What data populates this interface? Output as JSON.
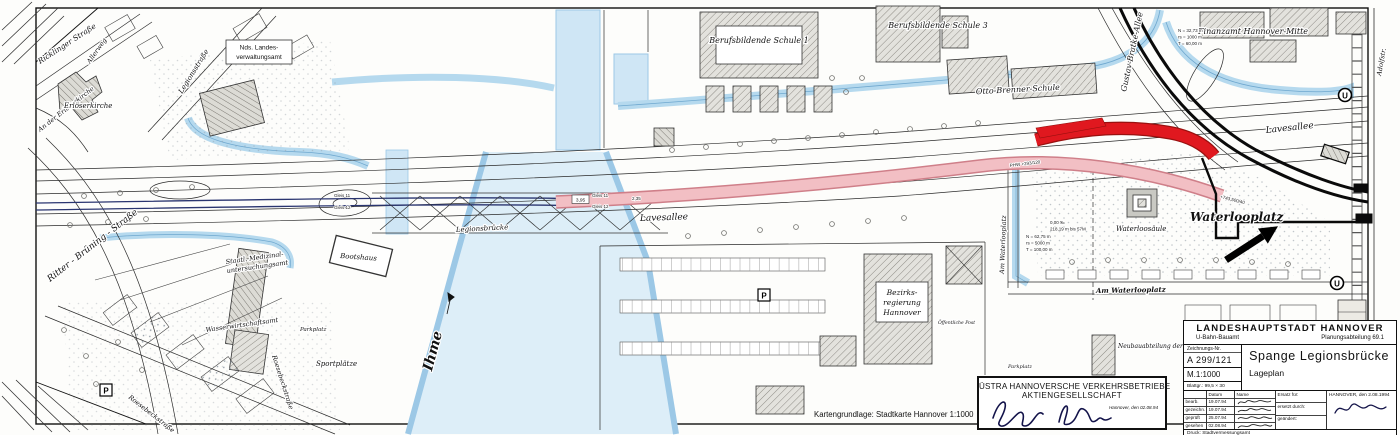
{
  "map": {
    "labels": {
      "ricklinger_strasse": "Ricklinger Straße",
      "allerweg": "Allerweg",
      "an_der_erloeserkirche": "An der Erlöserkirche",
      "erloeserkirche": "Erlöserkirche",
      "legionsstrasse": "Legionsstraße",
      "nds_landesamt_line1": "Nds. Landes-",
      "nds_landesamt_line2": "verwaltungsamt",
      "ritter_bruening_strasse": "Ritter - Brüning - Straße",
      "staatl_medizinal_line1": "Staatl. Medizinal-",
      "staatl_medizinal_line2": "untersuchungsamt",
      "wasserwirtschaftsamt": "Wasserwirtschaftsamt",
      "roesebeckstrasse": "Roesebeckstraße",
      "sportplaetze": "Sportplätze",
      "parkplatz": "Parkplatz",
      "bootshaus": "Bootshaus",
      "legionsbruecke": "Legionsbrücke",
      "ihme": "Ihme",
      "lavesallee": "Lavesallee",
      "berufsbildende_schule_1": "Berufsbildende Schule 1",
      "berufsbildende_schule_3": "Berufsbildende Schule 3",
      "otto_brenner_schule": "Otto-Brenner-Schule",
      "finanzamt": "Finanzamt Hannover-Mitte",
      "gustav_bratke_allee": "Gustav-Bratke-Allee",
      "adolfstrasse": "Adolfstr.",
      "waterlooplatz": "Waterlooplatz",
      "waterloosaeule": "Waterloosäule",
      "am_waterlooplatz": "Am Waterlooplatz",
      "bezirksregierung_line1": "Bezirks-",
      "bezirksregierung_line2": "regierung",
      "bezirksregierung_line3": "Hannover",
      "oeffentliche_post": "Öffentliche Post",
      "neubauabteilung_wsd": "Neubauabteilung der WSD"
    },
    "annotations": {
      "gleis_11": "Gleis 11",
      "gleis_12": "Gleis 12",
      "mass_3_95": "3,95",
      "mass_2_35": "2,35",
      "phw": "PHW +293/120",
      "station": "+743,500/40",
      "n_62": "N = 62,75 m",
      "rs_5000": "rs = 5000 m",
      "t_100": "T = 100,00 m",
      "grad_0": "0,00 ‰",
      "len_218": "218,19 m bis 57M",
      "n_32": "N = 32,73 m",
      "rs_1000": "rs = 1000 m",
      "t_60": "T = 60,00 m"
    },
    "symbols": {
      "u_station": "U",
      "parking": "P"
    }
  },
  "title_block": {
    "authority": "LANDESHAUPTSTADT  HANNOVER",
    "office": "U-Bahn-Bauamt",
    "department": "Planungsabteilung 69.1",
    "drawing_no_label": "Zeichnungs-Nr.",
    "drawing_no": "A  299/121",
    "scale": "M.1:1000",
    "sheet_label": "Blattgr.:",
    "sheet_size": "99,5 × 30",
    "project_title": "Spange  Legionsbrücke",
    "plan_type": "Lageplan",
    "col_datum": "Datum",
    "col_name": "Name",
    "col_ersatz": "Ersatz für:",
    "col_ersetzt": "ersetzt durch:",
    "col_geaendert": "geändert:",
    "rows": [
      {
        "label": "bearb.",
        "date": "19.07.94"
      },
      {
        "label": "gezeichn.",
        "date": "19.07.94"
      },
      {
        "label": "geprüft",
        "date": "25.07.94"
      },
      {
        "label": "gesehen",
        "date": "02.08.94"
      }
    ],
    "place_date": "HANNOVER, den  2.08.1994",
    "print_note": "Druck: Stadtvermessungsamt"
  },
  "ustra_box": {
    "line1": "ÜSTRA  HANNOVERSCHE  VERKEHRSBETRIEBE",
    "line2": "AKTIENGESELLSCHAFT",
    "place_date": "Hannover, den 02.08.94"
  },
  "footer": {
    "map_source": "Kartengrundlage: Stadtkarte Hannover 1:1000"
  }
}
